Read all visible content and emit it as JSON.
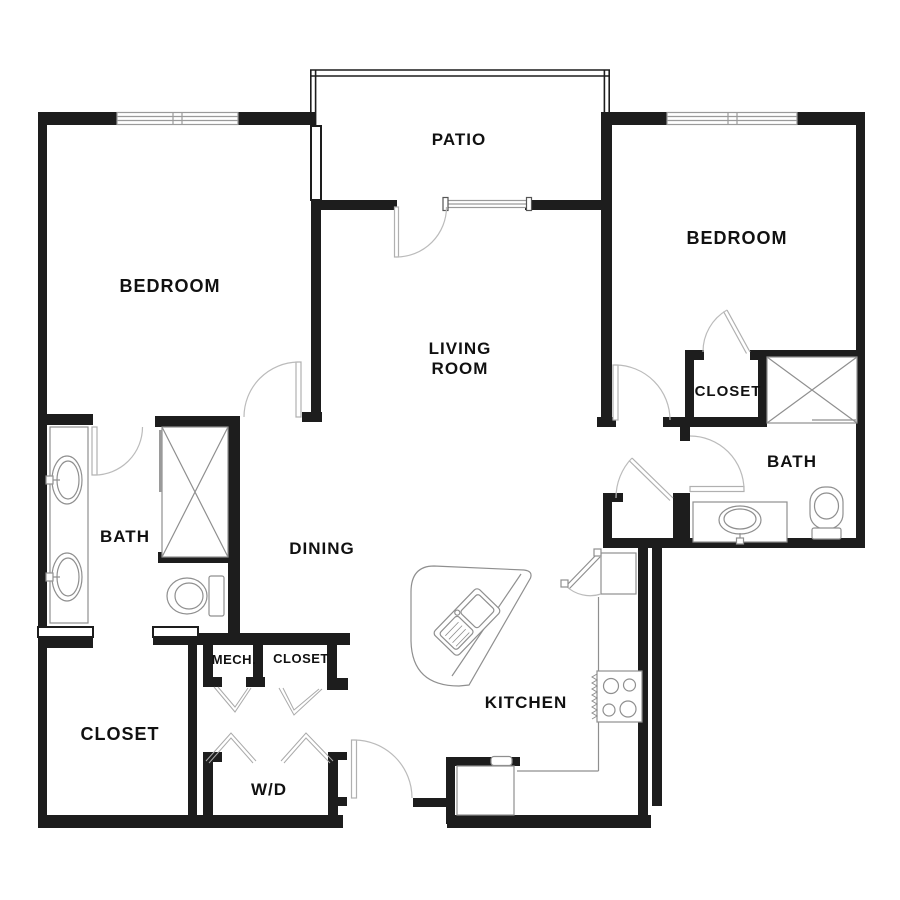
{
  "title": "Two bedroom apartment floor plan",
  "colors": {
    "background": "#ffffff",
    "walls": "#1d1d1d",
    "fixtures": "#8f8f8f",
    "doors": "#bbbbbb",
    "text": "#111111"
  },
  "labels": {
    "patio": "PATIO",
    "bedroom_left": "BEDROOM",
    "bedroom_right": "BEDROOM",
    "living_1": "LIVING",
    "living_2": "ROOM",
    "closet_bedroom_right": "CLOSET",
    "bath_right": "BATH",
    "bath_left": "BATH",
    "dining": "DINING",
    "mech": "MECH.",
    "closet_hall": "CLOSET",
    "closet_master": "CLOSET",
    "washer_dryer": "W/D",
    "kitchen": "KITCHEN"
  },
  "fixtures": [
    "window",
    "sliding-glass-door",
    "swing-door",
    "bifold-doors",
    "walk-in-shower",
    "double-sink-vanity",
    "toilet",
    "vanity-sink",
    "kitchen-island-sink",
    "range-stove",
    "refrigerator",
    "corner-pantry"
  ]
}
